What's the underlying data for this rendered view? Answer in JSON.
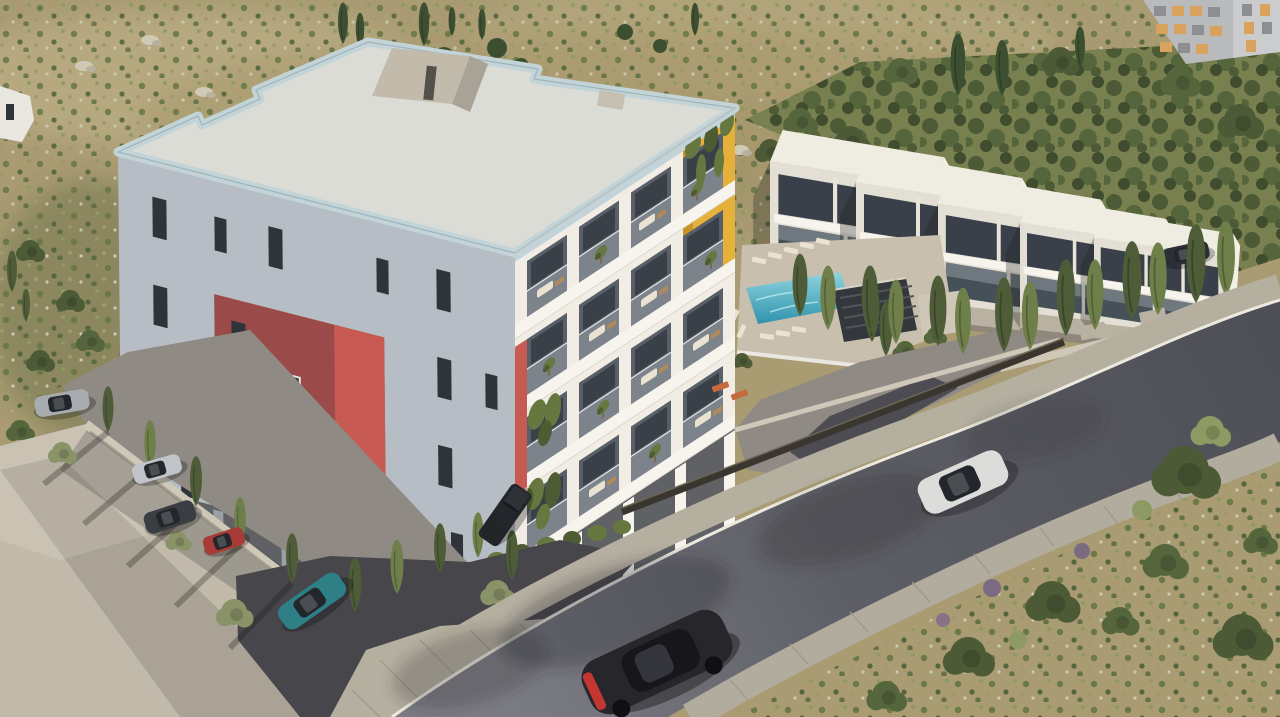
{
  "scene": {
    "description": "Aerial 3D architectural rendering: modern white 4-storey apartment building with red and yellow accent panels, row of five white villas with pool behind it, curving asphalt road with cars, Mediterranean scrubland hillside",
    "time_of_day": "late afternoon sun from upper right",
    "visible_text": []
  },
  "objects": {
    "main_building": {
      "storeys_visible": 4,
      "roof": "flat deck with pale-blue glass parapet and concrete stair bulkhead",
      "accents": [
        "red panel on left corner",
        "yellow panel on right edge"
      ],
      "balconies": "white grid with glass balustrades, sofas and potted plants",
      "ground_floor": "dark pilotis parking"
    },
    "villas": {
      "count": 5,
      "storeys": 2,
      "style": "white cubes with dark glazing"
    },
    "pool_area": {
      "water": "turquoise",
      "sun_loungers": 12,
      "pergola": "dark slatted roof"
    },
    "vehicles": {
      "on_road": [
        "white sedan",
        "black sports coupe with red tail light"
      ],
      "parked": [
        "silver sedan",
        "silver coupe",
        "dark gray suv",
        "red hatchback",
        "teal compact",
        "dark pickup",
        "dark suv beside villas"
      ]
    },
    "vegetation": {
      "cypress_trees_approx": 35,
      "olive_grove": true,
      "dry_scrubland": true
    },
    "roads": {
      "main_road": "curving asphalt, two paver sidewalks, white curb line"
    },
    "other_buildings": [
      "gray high-rise, top right corner",
      "white building corner, top left edge"
    ]
  },
  "palette": {
    "terrain_tan": "#a99b72",
    "terrain_tan_light": "#bcae84",
    "terrain_olive": "#8a8f5e",
    "scrub_green": "#6b7848",
    "scrub_green_dark": "#55653d",
    "scrub_green_light": "#8d9a63",
    "grove_bg": "#77804e",
    "grove_dark": "#4c5a36",
    "grove_darker": "#3f4c2e",
    "grove_mid": "#55653c",
    "rock": "#cfc9b6",
    "cypress": "#4e5d38",
    "cypress_light": "#6e7f4a",
    "bush_gray": "#8a9368",
    "conifer": "#3d4f31",
    "roof_deck": "#dcdcd6",
    "parapet": "#c3d4d8",
    "parapet_dark": "#9fb3ba",
    "bulkhead": "#c2bbac",
    "bulkhead_dark": "#a9a296",
    "facade_sun": "#f1ede4",
    "facade_shade": "#b7bdc4",
    "slab": "#f7f4ed",
    "cell_recess": "#585f68",
    "cell_inner": "#3a4048",
    "window_dark": "#2f343b",
    "ground_dark": "#5f6165",
    "pier_light": "#9aa0a6",
    "red_sun": "#c75b54",
    "red_shade": "#9a4a48",
    "yellow": "#e6b13a",
    "yellow_dark": "#c69427",
    "plant": "#66773f",
    "plant_dark": "#4d5c33",
    "furn_cream": "#eae3d1",
    "furn_wood": "#b08a5a",
    "pool": "#3fa9c2",
    "pool_light": "#8fd4de",
    "deck": "#c8bfae",
    "pergola": "#34373c",
    "villa_roof": "#efece2",
    "villa_front": "#e3dfd4",
    "villa_side": "#f4f0e6",
    "villa_glass": "#394049",
    "villa_glass2": "#465058",
    "terrace": "#b9b2a2",
    "plaza": "#c1baab",
    "parking": "#8f8a83",
    "drive_dark": "#46464b",
    "wall_light": "#cfc8b8",
    "fence": "#3a362f",
    "walkway": "#b5afa0",
    "paver_joint": "#a19b8c",
    "curb": "#eceadf",
    "road_dark": "#4e4e56",
    "road_light": "#7b7b83",
    "sidewalk": "#b2ac9e",
    "car_white": "#dcdcda",
    "car_silver": "#a7acb1",
    "car_silver2": "#c0c4c8",
    "car_dark": "#3a3d42",
    "car_black": "#26262b",
    "car_red": "#a83b36",
    "car_teal": "#2e7f86",
    "car_glass": "#23262b",
    "taillight": "#c33632",
    "orange_lounger": "#c76b3f",
    "white_struct": "#e9e7df",
    "highrise": "#b9babc",
    "highrise_light": "#cbcccd",
    "win_amber": "#d8a35f",
    "win_gray": "#8e8f93"
  }
}
